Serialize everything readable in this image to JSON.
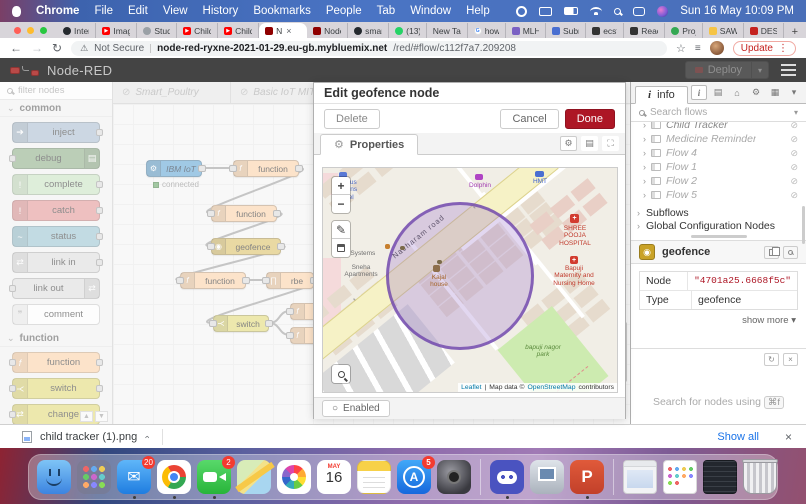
{
  "menu_bar": {
    "items": [
      "Chrome",
      "File",
      "Edit",
      "View",
      "History",
      "Bookmarks",
      "People",
      "Tab",
      "Window",
      "Help"
    ],
    "clock": "Sun 16 May 10:09 PM"
  },
  "tab_strip": {
    "tabs": [
      {
        "label": "Inter"
      },
      {
        "label": "Imag"
      },
      {
        "label": "Stud"
      },
      {
        "label": "Child"
      },
      {
        "label": "Child"
      },
      {
        "label": "N"
      },
      {
        "label": "Node"
      },
      {
        "label": "smar"
      },
      {
        "label": "(13)"
      },
      {
        "label": "New Tab"
      },
      {
        "label": "how"
      },
      {
        "label": "MLH"
      },
      {
        "label": "Subr"
      },
      {
        "label": "ecst"
      },
      {
        "label": "Reac"
      },
      {
        "label": "Proj"
      },
      {
        "label": "SAW"
      },
      {
        "label": "DES"
      }
    ],
    "close_glyph": "×",
    "new_tab_button": "+"
  },
  "address_bar": {
    "security_label": "Not Secure",
    "url_host": "node-red-ryxne-2021-01-29.eu-gb.mybluemix.net",
    "url_path": "/red/#flow/c112f7a7.209208",
    "update_button": "Update"
  },
  "nr_header": {
    "title": "Node-RED",
    "deploy_label": "Deploy"
  },
  "palette": {
    "filter_placeholder": "filter nodes",
    "section_common": "common",
    "section_function": "function",
    "common_nodes": [
      "inject",
      "debug",
      "complete",
      "catch",
      "status",
      "link in",
      "link out",
      "comment"
    ],
    "function_nodes": [
      "function",
      "switch",
      "change"
    ]
  },
  "workspace": {
    "flow_tabs": [
      "Smart_Poultry",
      "Basic IoT MIT",
      "Sm"
    ],
    "nodes": [
      {
        "label": "IBM IoT",
        "status": "connected"
      },
      {
        "label": "function"
      },
      {
        "label": "function"
      },
      {
        "label": "geofence"
      },
      {
        "label": "function"
      },
      {
        "label": "rbe"
      },
      {
        "label": "switch"
      }
    ]
  },
  "dialog": {
    "title": "Edit geofence node",
    "delete_button": "Delete",
    "cancel_button": "Cancel",
    "done_button": "Done",
    "tab_label": "Properties",
    "enabled_label": "Enabled",
    "map": {
      "zoom_in": "+",
      "zoom_out": "−",
      "labels": {
        "hostel": "St pious womens hostel",
        "dolphin": "Dolphin",
        "hmt": "HMT",
        "road": "Nacharam road",
        "vedic": "Vedic Systems",
        "sneha": "Sneha Apartments",
        "hospital": "SHREE POOJA HOSPITAL",
        "maternity": "Bapuji Maternity and Nursing Home",
        "kajal": "Kajal house",
        "park": "bapuji nagor park"
      },
      "attribution": {
        "leaflet": "Leaflet",
        "sep": "|",
        "map_data": "Map data ©",
        "osm": "OpenStreetMap",
        "contributors": "contributors"
      }
    }
  },
  "sidebar": {
    "tab_label": "info",
    "search_placeholder": "Search flows",
    "flows": [
      "Child Tracker",
      "Medicine Reminder",
      "Flow 4",
      "Flow 1",
      "Flow 2",
      "Flow 5"
    ],
    "sections": [
      "Subflows",
      "Global Configuration Nodes"
    ],
    "node_info": {
      "title": "geofence",
      "rows": [
        {
          "key": "Node",
          "value": "\"4701a25.6668f5c\""
        },
        {
          "key": "Type",
          "value": "geofence"
        }
      ],
      "show_more": "show more",
      "search_hint": "Search for nodes using",
      "search_key": "⌘f"
    }
  },
  "download_bar": {
    "filename": "child tracker (1).png",
    "show_all": "Show all",
    "close": "×"
  },
  "dock": {
    "calendar_month": "MAY",
    "calendar_day": "16",
    "badges": {
      "mail": "20",
      "facetime": "2",
      "app_store": "5"
    }
  },
  "colors": {
    "done_button": "#ad1625",
    "update_button": "#c5221f",
    "show_all_link": "#1a73e8",
    "nr_header_bg": "#444444",
    "inject_node": "#a6bbcf",
    "debug_node": "#87a980",
    "catch_node": "#e49191",
    "function_node": "#fdd0a2",
    "switch_node": "#e2d96e",
    "ibm_iot_node": "#57a0d3",
    "geofence_node": "#dbbd5c",
    "geofence_circle": "#683ea8",
    "connected_status": "#5a9e5a"
  }
}
